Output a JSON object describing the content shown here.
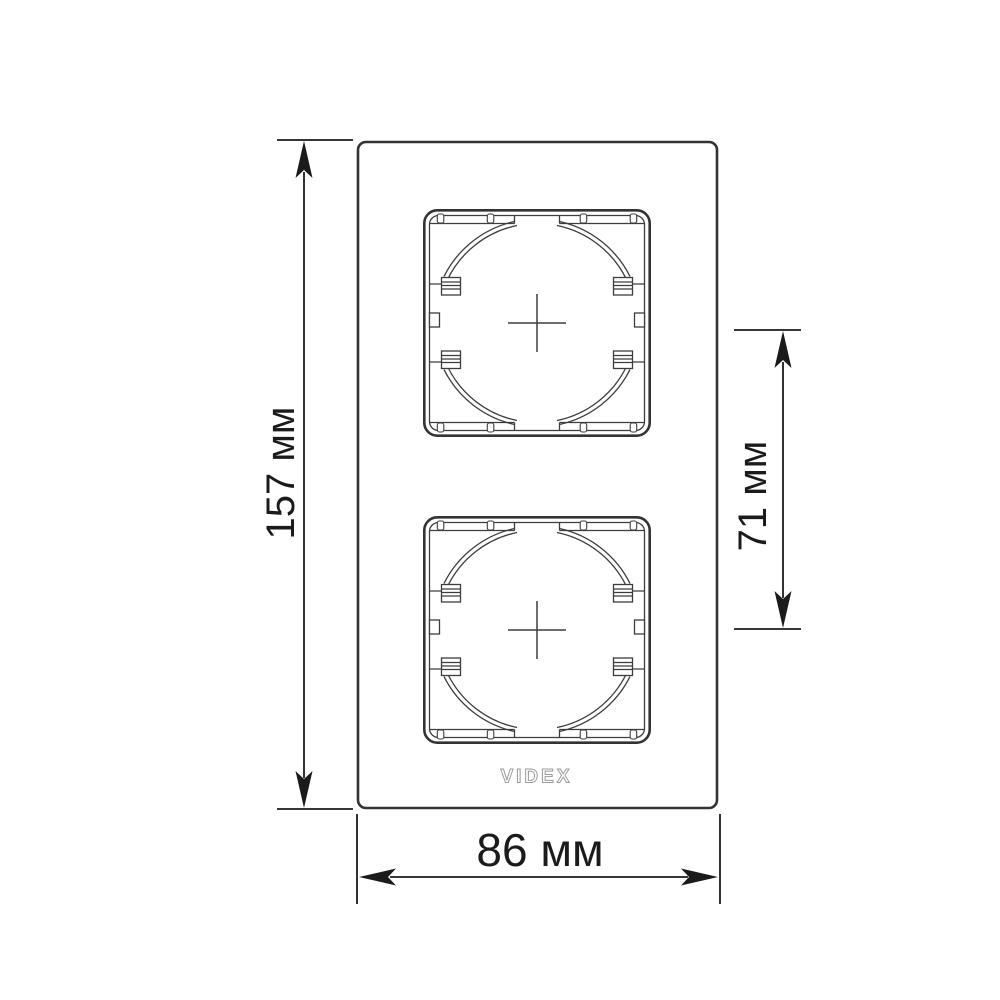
{
  "drawing": {
    "title": "faceplate-dimensional-drawing",
    "brand_logo": "VIDEX",
    "dimensions": {
      "height": "157 мм",
      "spacing": "71 мм",
      "width": "86 мм"
    },
    "colors": {
      "outline": "#333333",
      "detail": "#3d3d3d",
      "dimension": "#1b1b1b",
      "logo": "#9b9b9b",
      "background": "#ffffff"
    }
  }
}
